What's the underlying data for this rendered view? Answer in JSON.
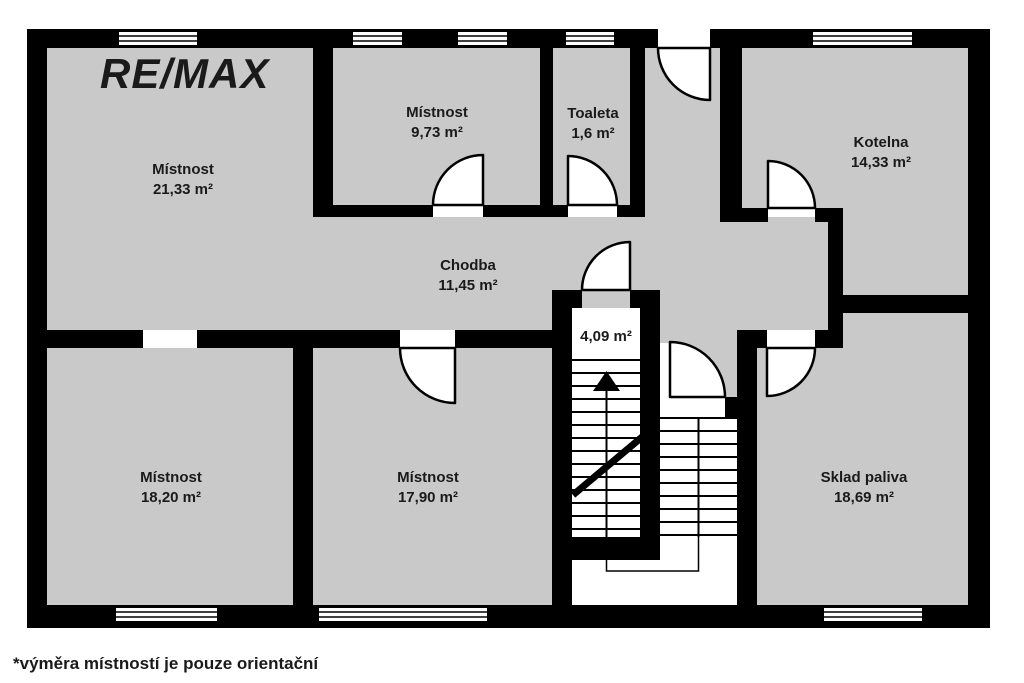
{
  "branding": {
    "logo_text": "RE/MAX",
    "logo_color": "#545456"
  },
  "plan": {
    "type": "floor-plan",
    "rooms": [
      {
        "key": "mistnost-2133",
        "name": "Místnost",
        "area": "21,33 m²"
      },
      {
        "key": "mistnost-973",
        "name": "Místnost",
        "area": "9,73 m²"
      },
      {
        "key": "toaleta",
        "name": "Toaleta",
        "area": "1,6 m²"
      },
      {
        "key": "kotelna",
        "name": "Kotelna",
        "area": "14,33 m²"
      },
      {
        "key": "chodba",
        "name": "Chodba",
        "area": "11,45 m²"
      },
      {
        "key": "schodiste",
        "name": "",
        "area": "4,09 m²"
      },
      {
        "key": "mistnost-1820",
        "name": "Místnost",
        "area": "18,20 m²"
      },
      {
        "key": "mistnost-1790",
        "name": "Místnost",
        "area": "17,90 m²"
      },
      {
        "key": "sklad-paliva",
        "name": "Sklad paliva",
        "area": "18,69 m²"
      }
    ],
    "colors": {
      "wall": "#000000",
      "room_fill": "#c9c9c9",
      "background": "#ffffff"
    }
  },
  "footer": {
    "disclaimer": "*výměra místností je pouze orientační"
  }
}
